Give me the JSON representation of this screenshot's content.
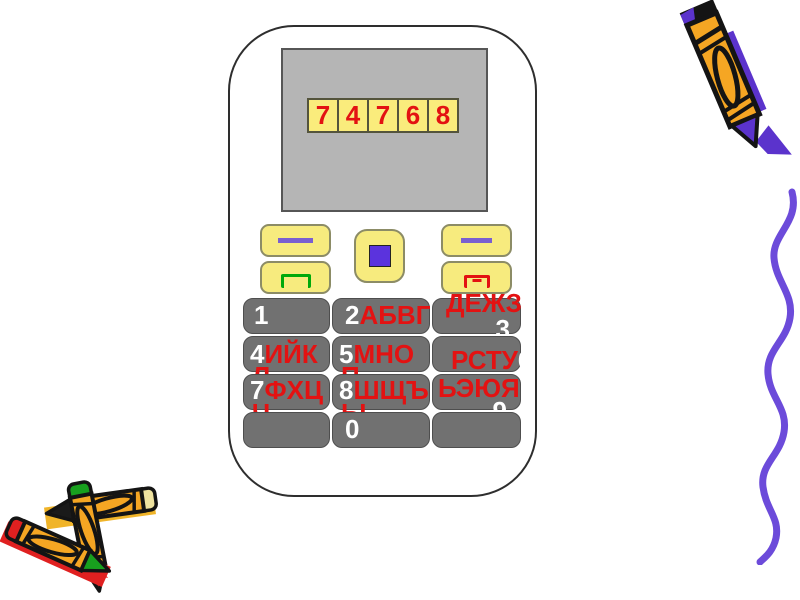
{
  "slide": {
    "background": "#FFFFFF",
    "description": "presentation slide with clipart mobile phone dialing 74768"
  },
  "phone": {
    "display": {
      "digits": [
        "7",
        "4",
        "7",
        "6",
        "8"
      ],
      "value": "74768"
    },
    "controls": {
      "left_softkey_icon": "purple-dash",
      "right_softkey_icon": "purple-dash",
      "center_key_icon": "purple-square",
      "call_key_icon": "green-call-bracket",
      "end_key_icon": "red-end-call-bracket-with-minus"
    },
    "keypad": {
      "key1": {
        "number": "1",
        "letters": ""
      },
      "key2": {
        "number": "2",
        "letters": "АБВГ"
      },
      "key3": {
        "number": "3",
        "letters": "ДЕЖЗ"
      },
      "key4": {
        "number": "4",
        "letters": "ИЙК",
        "letters_wrap": "Л"
      },
      "key5": {
        "number": "5",
        "letters": "МНО",
        "letters_wrap": "П"
      },
      "key6": {
        "number": "6",
        "letters": "РСТУ"
      },
      "key7": {
        "number": "7",
        "letters": "ФХЦ",
        "letters_wrap": "Ч"
      },
      "key8": {
        "number": "8",
        "letters": "ШЩЪ",
        "letters_wrap": "Ы"
      },
      "key9": {
        "number": "9",
        "letters": "ЬЭЮЯ"
      },
      "key0": {
        "number": "0",
        "letters": ""
      },
      "key_blank_left": {
        "number": "",
        "letters": ""
      },
      "key_blank_right": {
        "number": "",
        "letters": ""
      }
    }
  },
  "colors": {
    "phone_outline": "#2E2E2E",
    "screen_gray": "#B5B5B5",
    "display_cell_yellow": "#FAEC7C",
    "button_yellow": "#F7EB7E",
    "key_gray": "#717171",
    "text_red": "#E31212",
    "number_white": "#FFFFFF",
    "accent_purple": "#5B33DD",
    "call_green": "#00A90B",
    "crayon_gold": "#F5A623",
    "squiggle_purple": "#6C4BDA"
  },
  "decorations": {
    "top_right": "gold-crayon-with-purple-tip",
    "right_side": "purple-wavy-squiggle-line",
    "bottom_left": "pile-of-three-crayons"
  }
}
